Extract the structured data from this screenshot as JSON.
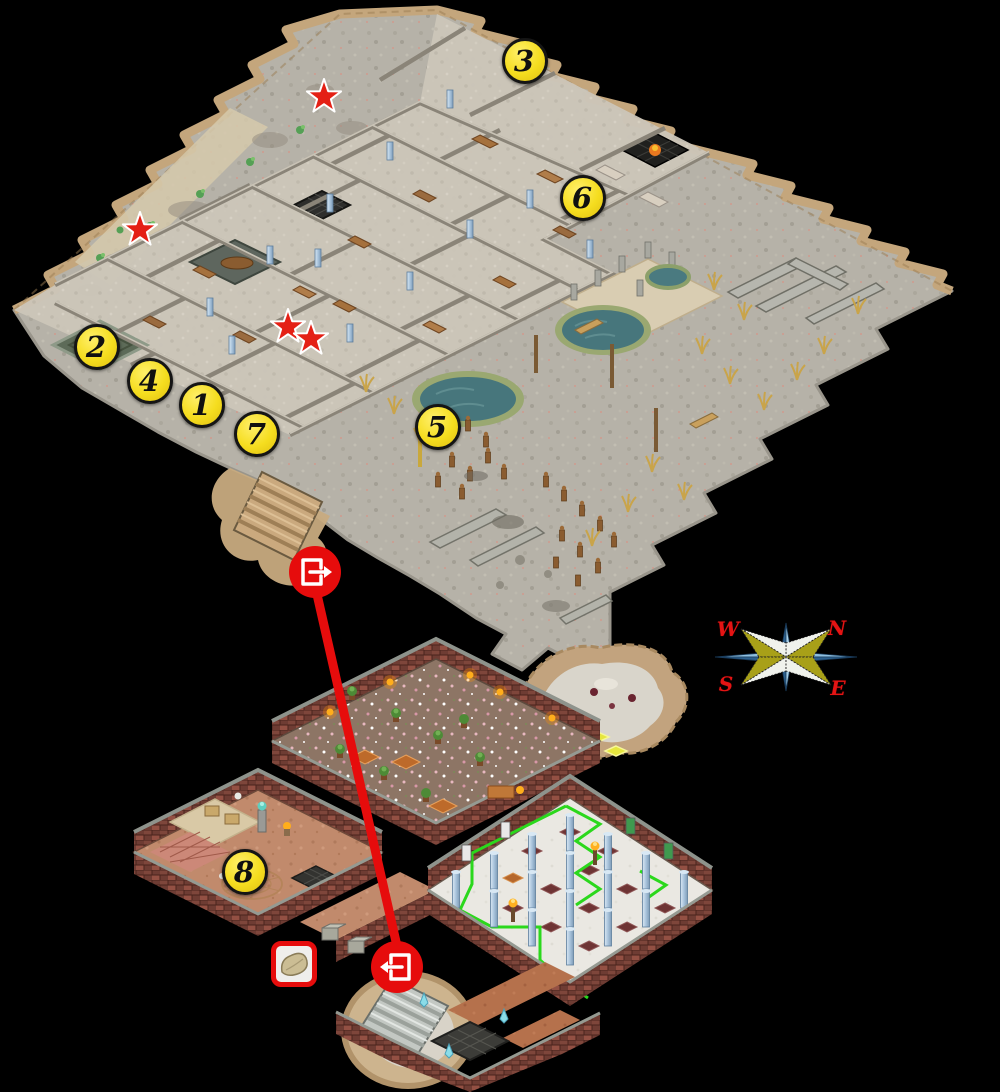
{
  "scene": {
    "description": "isometric dungeon walkthrough map with two levels connected by a stairway route",
    "background_color": "#000000"
  },
  "markers": [
    {
      "label": "1",
      "x": 202,
      "y": 405,
      "map": "upper"
    },
    {
      "label": "2",
      "x": 97,
      "y": 347,
      "map": "upper"
    },
    {
      "label": "3",
      "x": 525,
      "y": 61,
      "map": "upper"
    },
    {
      "label": "4",
      "x": 150,
      "y": 381,
      "map": "upper"
    },
    {
      "label": "5",
      "x": 438,
      "y": 427,
      "map": "upper"
    },
    {
      "label": "6",
      "x": 583,
      "y": 198,
      "map": "upper"
    },
    {
      "label": "7",
      "x": 257,
      "y": 434,
      "map": "upper"
    },
    {
      "label": "8",
      "x": 245,
      "y": 872,
      "map": "lower"
    }
  ],
  "marker_style": {
    "fill": "#f3da1e",
    "border": "#151515",
    "text_color": "#101010"
  },
  "stars": {
    "color": "#e42015",
    "positions": [
      {
        "x": 324,
        "y": 97
      },
      {
        "x": 140,
        "y": 230
      },
      {
        "x": 288,
        "y": 327
      },
      {
        "x": 311,
        "y": 339
      }
    ]
  },
  "route": {
    "color": "#e60c0c",
    "exit_icon": {
      "name": "exit-door-icon",
      "x": 315,
      "y": 572
    },
    "enter_icon": {
      "name": "enter-door-icon",
      "x": 397,
      "y": 967
    }
  },
  "item_box": {
    "icon": "pillow-item-icon",
    "border_color": "#e60c0c",
    "x": 293,
    "y": 963
  },
  "compass": {
    "labels": {
      "w": "W",
      "n": "N",
      "s": "S",
      "e": "E"
    },
    "letter_color": "#e41414",
    "center_x": 786,
    "center_y": 657
  }
}
